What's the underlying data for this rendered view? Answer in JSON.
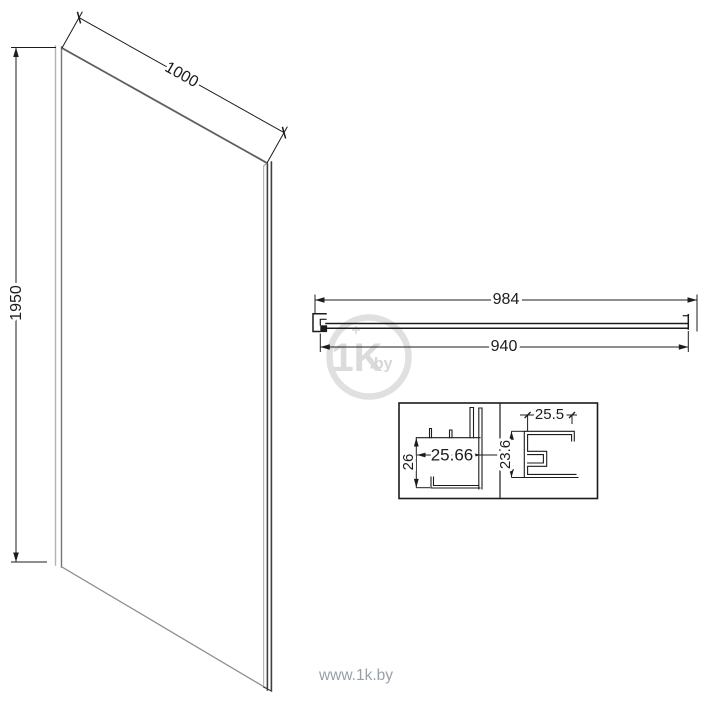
{
  "drawing": {
    "panel": {
      "height": "1950",
      "width": "1000"
    },
    "profile_bar": {
      "outer_width": "984",
      "glass_width": "940"
    },
    "detail_profiles": {
      "wall_profile": {
        "width": "25.66",
        "depth": "26"
      },
      "glass_profile": {
        "width": "25.5",
        "depth": "23.6"
      }
    }
  },
  "watermark": {
    "logo": "1K",
    "logo_tld": ".by",
    "site_url": "www.1k.by"
  },
  "colors": {
    "line": "#1c1c1c",
    "panel_edge_dark": "#5f5f5f",
    "panel_edge_mid": "#404040",
    "panel_edge_light": "#b3b3b3",
    "watermark": "#dbdbdb",
    "url_text": "#99a0a7"
  }
}
